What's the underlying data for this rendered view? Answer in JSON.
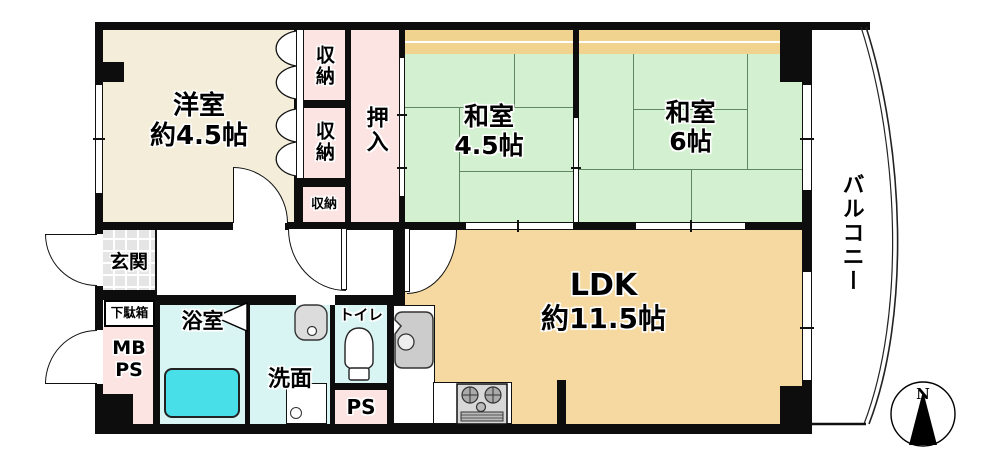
{
  "floorplan": {
    "rooms": {
      "western": {
        "name": "洋室",
        "size": "約4.5帖"
      },
      "japanese45": {
        "name": "和室",
        "size": "4.5帖"
      },
      "japanese6": {
        "name": "和室",
        "size": "6帖"
      },
      "ldk": {
        "name": "LDK",
        "size": "約11.5帖"
      },
      "oshiire": {
        "name": "押入"
      },
      "closet_top": {
        "name": "収納"
      },
      "closet_mid": {
        "name": "収納"
      },
      "closet_small": {
        "name": "収納"
      },
      "balcony": {
        "name": "バルコニー"
      },
      "genkan": {
        "name": "玄関"
      },
      "getabako": {
        "name": "下駄箱"
      },
      "mb_ps": {
        "line1": "MB",
        "line2": "PS"
      },
      "bathroom": {
        "name": "浴室"
      },
      "washroom": {
        "name": "洗面"
      },
      "toilet": {
        "name": "トイレ"
      },
      "pipe_space": {
        "name": "PS"
      }
    },
    "compass": {
      "north_label": "N"
    },
    "fixtures": [
      "bathtub",
      "washing-machine",
      "washbasin",
      "kitchen-sink",
      "gas-stove",
      "toilet-bowl",
      "folding-bath-door"
    ],
    "colors": {
      "wall": "#0d0d0d",
      "western_room": "#f3edd9",
      "closet_pink": "#fbe4e2",
      "tatami_green": "#d3f1d0",
      "tatami_line": "#5f8760",
      "board_strip": "#f1d390",
      "ldk_orange": "#f6d9a0",
      "wet_area_cyan": "#d9f5f3",
      "bathtub_cyan": "#48dfe9",
      "entrance_tile": "#e5e5e5"
    }
  }
}
